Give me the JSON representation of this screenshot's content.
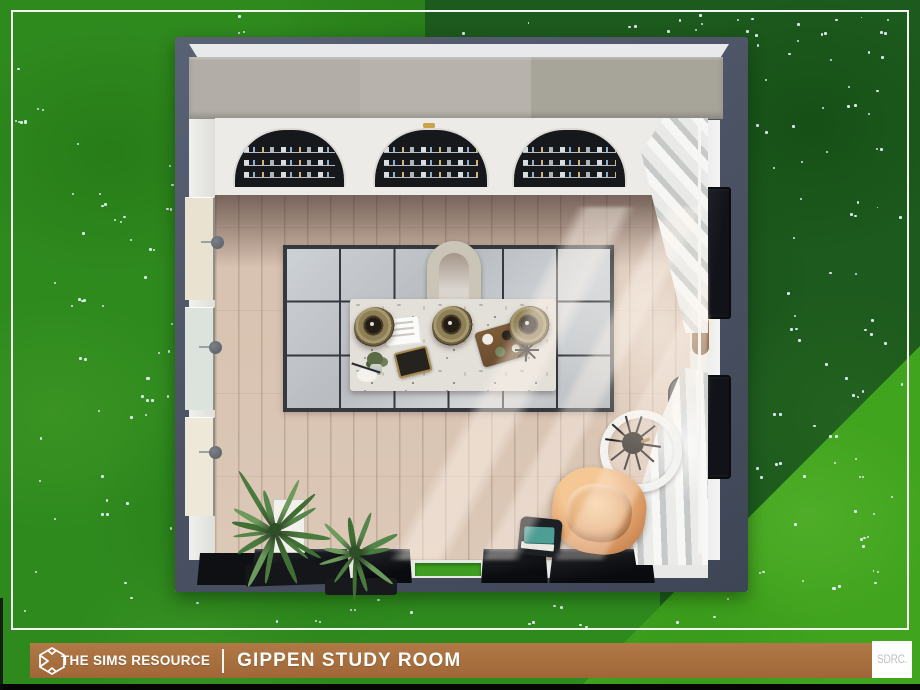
{
  "banner": {
    "brand": "THE SIMS RESOURCE",
    "title": "GIPPEN STUDY ROOM"
  },
  "watermark": {
    "label": "SDRC."
  },
  "palette": {
    "grass_base": "#2f8a1e",
    "grass_dark": "#1d5a1d",
    "grass_bright": "#41a41e",
    "flower_dot": "#e6eef8",
    "banner_brown": "#a76f3f",
    "banner_text": "#ffffff",
    "watermark_text": "#c1c1c1",
    "wall_slate": "#4b5365",
    "wall_white": "#edebe7",
    "cabinet_gray": "#b2aea7",
    "bookshelf_dark": "#17181c",
    "floor_wood": "#d8c2b1",
    "rug_gray": "#c6c9cc",
    "rug_grid": "#35383c",
    "table_marble": "#e3dfd9",
    "pendant_rattan": "#8f7f57",
    "armchair_leather": "#df9f68",
    "curtain_white": "#f6f6f4",
    "plant_green": "#55854a",
    "pot_black": "#14161a",
    "lamp_ring": "#f3f3f1"
  },
  "scene": {
    "elements": [
      "arched-bookshelf-wall",
      "grid-rug",
      "terrazzo-table",
      "pendant-lamp",
      "arch-chair",
      "ring-floor-lamp",
      "leather-armchair",
      "side-table",
      "palm-plant",
      "white-curtains",
      "arched-window",
      "wall-sconce",
      "doorway"
    ]
  }
}
